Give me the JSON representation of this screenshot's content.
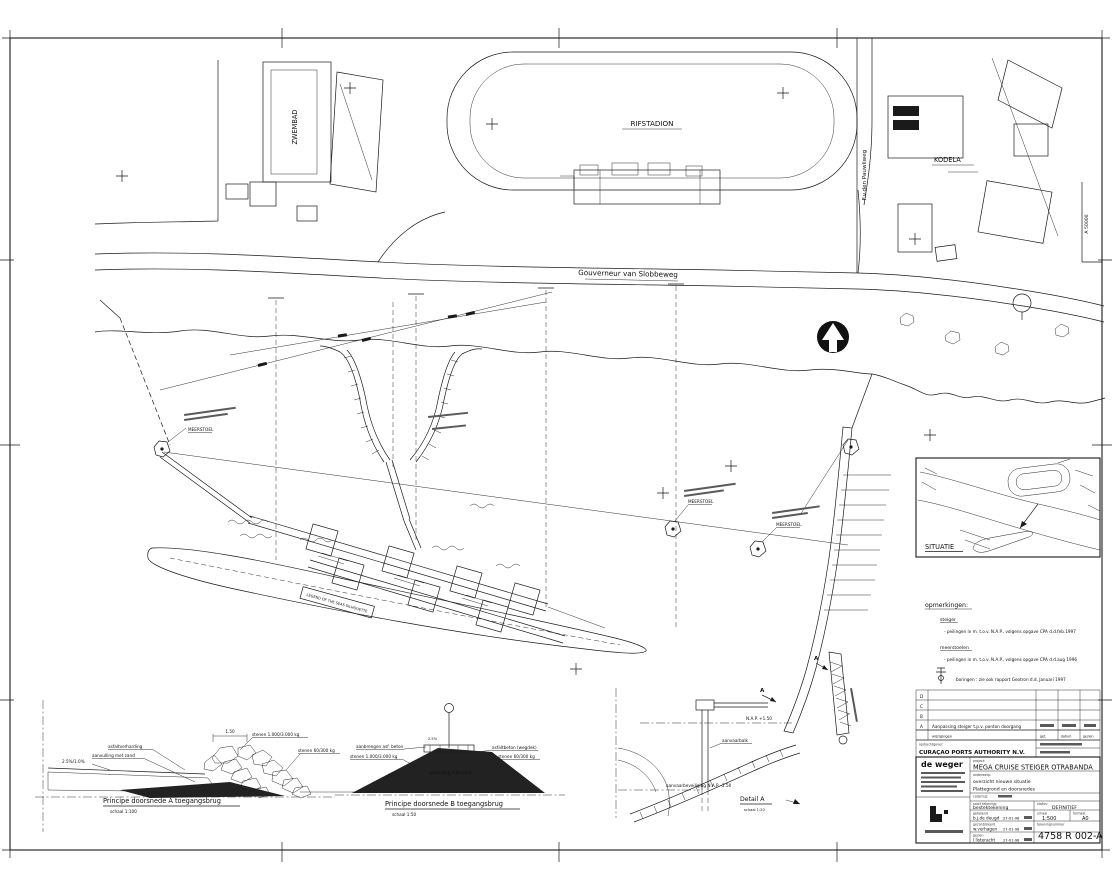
{
  "site": {
    "zwembad": "ZWEMBAD",
    "rifstadion": "RIFSTADION",
    "kodela": "KODELA",
    "road_main": "Gouverneur van Slobbeweg",
    "road_side": "F.v.den Pauwliweg",
    "parcel_ref": "A 50000"
  },
  "pier": {
    "ship_box": "LEGEND OF THE SEAS SILHOUETTE",
    "meerstoel": "MEERSTOEL",
    "cut_marker": "A"
  },
  "situatie": {
    "label": "SITUATIE"
  },
  "notes": {
    "title": "opmerkingen:",
    "h1": "steiger",
    "i1": "- peilingen in m. t.o.v. N.A.P., volgens opgave CPA d.d.feb.1997",
    "h2": "meerstoelen",
    "i2": "- peilingen in m. t.o.v. N.A.P., volgens opgave CPA d.d.aug 1996",
    "i3": "boringen : zie ook rapport Geotron d.d. Januari 1997"
  },
  "revisions": {
    "letters": [
      "D",
      "C",
      "B",
      "A"
    ],
    "row_a_text": "Aanpassing steiger t.p.v. ponton doorgang",
    "footer": "wijzigingen",
    "col1": "get.",
    "col2": "datum",
    "col3": "gezien"
  },
  "title_block": {
    "client_label": "opdrachtgever:",
    "client": "CURAÇAO PORTS AUTHORITY N.V.",
    "firm": "de weger",
    "project_label": "project:",
    "project": "MEGA CRUISE STEIGER OTRABANDA",
    "subject_label": "onderwerp:",
    "subject1": "overzicht nieuwe situatie",
    "subject2": "Plattegrond en doorsnedes",
    "code_label": "codering:",
    "soort_label": "soort tekening:",
    "soort": "bestektekening",
    "status_label": "status:",
    "status": "DEFINITIEF",
    "r1_label": "getekend",
    "r1_name": "b.j.de deugd",
    "r1_date": "27-01-98",
    "r2_label": "gecontroleerd",
    "r2_name": "w.verhagen",
    "r2_date": "27-01-98",
    "r3_label": "gezien",
    "r3_name": "l.listeracht",
    "r3_date": "27-01-98",
    "schaal_label": "schaal",
    "schaal": "1:500",
    "formaat_label": "formaat",
    "formaat": "A0",
    "number_label": "tekeningnummer",
    "number": "4758 R 002-A"
  },
  "sections": {
    "a": {
      "title": "Principe doorsnede A toegangsbrug",
      "scale": "schaal 1:100",
      "l_slope": "2.5%/1.0%",
      "l_pav": "asfaltverharding",
      "l_fill": "aanvulling met zand",
      "l_dim": "1.50",
      "l_stone1": "stenen 1.000/3.000 kg",
      "l_stone2": "stenen 60/300 kg"
    },
    "b": {
      "title": "Principe doorsnede B toegangsbrug",
      "scale": "schaal 1:50",
      "l1": "aanbrengen asf. beton",
      "l2": "stenen 1.000/3.000 kg",
      "l3": "2.5%",
      "l4": "asfaltbeton (wegdek)",
      "l5": "stenen 60/300 kg",
      "l6": "aanvulling met zand",
      "l7": "1:1.5"
    },
    "detail": {
      "title": "Detail A",
      "scale": "schaal 1:20",
      "l_nap": "N.A.P. +1.50",
      "l_balk": "aanvaarbalk",
      "l_bev": "aanvaarbeveiliging N.A.P. -2.50"
    }
  }
}
